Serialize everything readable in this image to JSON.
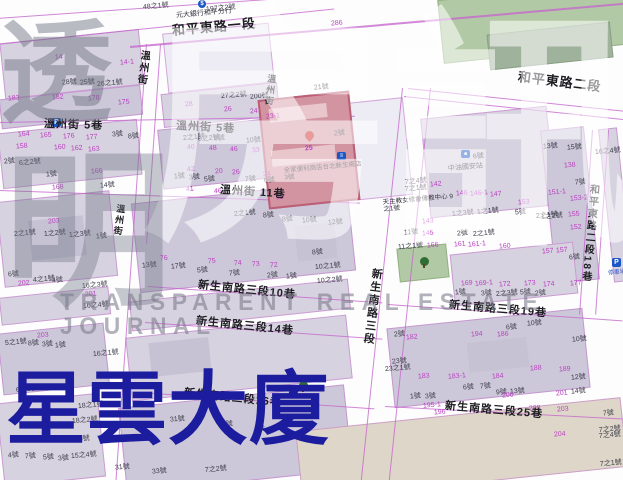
{
  "title": {
    "text": "星雲大廈",
    "color": "#1c1c9e"
  },
  "watermark": {
    "char_top": "透",
    "char_bottom": "明",
    "big_char_1": "房",
    "big_char_2": "訊",
    "banner": "TRANSPARENT REAL ESTATE JOURNAL"
  },
  "subject": {
    "store_label": "全家便利商店台北新生南店",
    "store_no": "3號",
    "marker_no": "25"
  },
  "pois": {
    "bank": {
      "label": "元大銀行和平分行",
      "icon": "$"
    },
    "gas": {
      "no": "6號",
      "label": "中油國安站"
    },
    "church": {
      "label": "天主教女修會傳教中心",
      "no": "9之1號"
    },
    "parking_left": {
      "icon": "P"
    },
    "parking_right": {
      "icon": "P",
      "label": "停車場"
    }
  },
  "streets": [
    [
      "和平東路一段",
      172,
      24,
      13,
      -5,
      0
    ],
    [
      "和平東路二段",
      518,
      70,
      13,
      7,
      0
    ],
    [
      "溫州街",
      139,
      50,
      10,
      7,
      1
    ],
    [
      "溫州街",
      267,
      74,
      9,
      7,
      1
    ],
    [
      "溫州街",
      116,
      204,
      9,
      7,
      1
    ],
    [
      "溫州街 5巷",
      44,
      119,
      11,
      2,
      0
    ],
    [
      "溫州街 5巷",
      176,
      121,
      11,
      3,
      0
    ],
    [
      "溫州街 11巷",
      220,
      185,
      11,
      4,
      0
    ],
    [
      "新生南路三段10巷",
      198,
      280,
      11,
      6,
      0
    ],
    [
      "新生南路三段14巷",
      196,
      316,
      11,
      6,
      0
    ],
    [
      "新生南路三段16巷",
      184,
      388,
      11,
      6,
      0
    ],
    [
      "新生南路三段19巷",
      449,
      300,
      11,
      5,
      0
    ],
    [
      "新生南路三段25巷",
      445,
      401,
      11,
      5,
      0
    ],
    [
      "新生南路三段",
      371,
      268,
      11,
      7,
      1
    ],
    [
      "和平東路二段18巷",
      588,
      184,
      10,
      5,
      1
    ]
  ],
  "lots": [
    [
      "48之1號",
      143,
      3,
      "k"
    ],
    [
      "197之2號",
      206,
      5,
      "k"
    ],
    [
      "286",
      331,
      20,
      "m"
    ],
    [
      "21號",
      314,
      84,
      "k"
    ],
    [
      "14",
      55,
      54,
      "m"
    ],
    [
      "14-1",
      120,
      59,
      "m"
    ],
    [
      "28號",
      62,
      79,
      "k"
    ],
    [
      "25號",
      80,
      79,
      "k"
    ],
    [
      "26之1號",
      97,
      80,
      "k"
    ],
    [
      "183",
      8,
      95,
      "m"
    ],
    [
      "182",
      52,
      94,
      "m"
    ],
    [
      "178",
      88,
      95,
      "m"
    ],
    [
      "175",
      118,
      99,
      "m"
    ],
    [
      "27之2號",
      221,
      92,
      "k"
    ],
    [
      "200號",
      250,
      93,
      "k"
    ],
    [
      "28",
      185,
      101,
      "m"
    ],
    [
      "26",
      224,
      106,
      "m"
    ],
    [
      "24",
      250,
      108,
      "m"
    ],
    [
      "23-1",
      266,
      113,
      "m"
    ],
    [
      "164",
      18,
      131,
      "m"
    ],
    [
      "165",
      40,
      132,
      "m"
    ],
    [
      "176",
      63,
      133,
      "m"
    ],
    [
      "177",
      86,
      134,
      "m"
    ],
    [
      "3號",
      112,
      131,
      "k"
    ],
    [
      "8號",
      128,
      133,
      "k"
    ],
    [
      "158",
      16,
      143,
      "m"
    ],
    [
      "160",
      54,
      144,
      "m"
    ],
    [
      "162",
      71,
      145,
      "m"
    ],
    [
      "163",
      88,
      146,
      "m"
    ],
    [
      "2號",
      4,
      158,
      "k"
    ],
    [
      "6之2號",
      19,
      159,
      "k"
    ],
    [
      "166",
      91,
      168,
      "m"
    ],
    [
      "1號",
      46,
      171,
      "k"
    ],
    [
      "168",
      52,
      184,
      "m"
    ],
    [
      "14號",
      100,
      182,
      "k"
    ],
    [
      "2之1號",
      183,
      134,
      "k"
    ],
    [
      "6之2號",
      198,
      135,
      "k"
    ],
    [
      "8號",
      214,
      135,
      "k"
    ],
    [
      "10號",
      246,
      137,
      "k"
    ],
    [
      "40",
      187,
      144,
      "m"
    ],
    [
      "48",
      209,
      145,
      "m"
    ],
    [
      "46",
      230,
      146,
      "m"
    ],
    [
      "33",
      252,
      147,
      "m"
    ],
    [
      "42",
      187,
      166,
      "m"
    ],
    [
      "20",
      215,
      168,
      "m"
    ],
    [
      "26",
      232,
      169,
      "m"
    ],
    [
      "24",
      263,
      171,
      "m"
    ],
    [
      "1號",
      174,
      173,
      "k"
    ],
    [
      "3號",
      189,
      174,
      "k"
    ],
    [
      "5號",
      204,
      176,
      "k"
    ],
    [
      "7號",
      245,
      176,
      "k"
    ],
    [
      "6號",
      264,
      177,
      "k"
    ],
    [
      "41",
      186,
      186,
      "m"
    ],
    [
      "46",
      214,
      188,
      "m"
    ],
    [
      "98",
      276,
      194,
      "m"
    ],
    [
      "2號",
      334,
      130,
      "k"
    ],
    [
      "2之1號",
      234,
      210,
      "k"
    ],
    [
      "8號",
      263,
      212,
      "k"
    ],
    [
      "8號",
      282,
      216,
      "k"
    ],
    [
      "10號",
      302,
      217,
      "k"
    ],
    [
      "12號",
      328,
      219,
      "k"
    ],
    [
      "203",
      48,
      218,
      "m"
    ],
    [
      "2之1號",
      14,
      230,
      "k"
    ],
    [
      "1之2號",
      44,
      230,
      "k"
    ],
    [
      "1之3號",
      69,
      231,
      "k"
    ],
    [
      "1號",
      96,
      233,
      "k"
    ],
    [
      "6號",
      8,
      271,
      "k"
    ],
    [
      "4之1號",
      33,
      276,
      "k"
    ],
    [
      "4號",
      52,
      277,
      "k"
    ],
    [
      "202",
      18,
      280,
      "m"
    ],
    [
      "16之3號",
      82,
      282,
      "k"
    ],
    [
      "201",
      85,
      291,
      "m"
    ],
    [
      "16之4號",
      83,
      302,
      "k"
    ],
    [
      "13號",
      142,
      262,
      "k"
    ],
    [
      "17號",
      171,
      263,
      "k"
    ],
    [
      "5號",
      197,
      267,
      "k"
    ],
    [
      "7號",
      229,
      270,
      "k"
    ],
    [
      "2號",
      267,
      272,
      "k"
    ],
    [
      "1號",
      286,
      273,
      "k"
    ],
    [
      "76",
      160,
      255,
      "m"
    ],
    [
      "75",
      208,
      258,
      "m"
    ],
    [
      "74",
      234,
      260,
      "m"
    ],
    [
      "73",
      252,
      261,
      "m"
    ],
    [
      "72",
      270,
      262,
      "m"
    ],
    [
      "203",
      37,
      332,
      "m"
    ],
    [
      "5之1號",
      5,
      339,
      "k"
    ],
    [
      "8號",
      28,
      340,
      "k"
    ],
    [
      "3號",
      42,
      341,
      "k"
    ],
    [
      "1號",
      55,
      342,
      "k"
    ],
    [
      "16之1號",
      93,
      350,
      "k"
    ],
    [
      "6之2號",
      16,
      386,
      "k"
    ],
    [
      "178",
      112,
      373,
      "m"
    ],
    [
      "18之1號",
      78,
      402,
      "k"
    ],
    [
      "18之2號",
      72,
      417,
      "k"
    ],
    [
      "2之3號",
      68,
      436,
      "k"
    ],
    [
      "15之4號",
      71,
      452,
      "k"
    ],
    [
      "4號",
      8,
      452,
      "k"
    ],
    [
      "7號",
      25,
      453,
      "k"
    ],
    [
      "5號",
      43,
      454,
      "k"
    ],
    [
      "3號",
      58,
      455,
      "k"
    ],
    [
      "31號",
      170,
      416,
      "k"
    ],
    [
      "6號",
      222,
      421,
      "k"
    ],
    [
      "4號",
      254,
      426,
      "k"
    ],
    [
      "31號",
      115,
      464,
      "k"
    ],
    [
      "33號",
      152,
      468,
      "k"
    ],
    [
      "7之2號",
      205,
      466,
      "k"
    ],
    [
      "7之4號",
      405,
      178,
      "k"
    ],
    [
      "7之1號",
      405,
      185,
      "k"
    ],
    [
      "142",
      430,
      181,
      "m"
    ],
    [
      "146",
      456,
      190,
      "m"
    ],
    [
      "146-1",
      470,
      190,
      "m"
    ],
    [
      "147",
      490,
      191,
      "m"
    ],
    [
      "153",
      518,
      199,
      "m"
    ],
    [
      "1之3號",
      452,
      210,
      "k"
    ],
    [
      "1之1號",
      477,
      208,
      "k"
    ],
    [
      "5號",
      515,
      209,
      "k"
    ],
    [
      "2之1號",
      536,
      212,
      "k"
    ],
    [
      "143",
      422,
      218,
      "m"
    ],
    [
      "11號",
      404,
      229,
      "k"
    ],
    [
      "145",
      422,
      230,
      "m"
    ],
    [
      "2號",
      457,
      230,
      "k"
    ],
    [
      "2之1號",
      473,
      230,
      "k"
    ],
    [
      "13號",
      543,
      143,
      "k"
    ],
    [
      "15號",
      567,
      144,
      "k"
    ],
    [
      "16之4號",
      595,
      148,
      "k"
    ],
    [
      "138",
      564,
      162,
      "m"
    ],
    [
      "7號",
      575,
      179,
      "k"
    ],
    [
      "151-1",
      548,
      189,
      "m"
    ],
    [
      "153-2",
      570,
      195,
      "m"
    ],
    [
      "155",
      568,
      211,
      "m"
    ],
    [
      "1之2號",
      541,
      213,
      "k"
    ],
    [
      "152",
      570,
      224,
      "m"
    ],
    [
      "157",
      556,
      247,
      "m"
    ],
    [
      "6號",
      569,
      254,
      "k"
    ],
    [
      "11之1號",
      398,
      243,
      "k"
    ],
    [
      "166",
      427,
      242,
      "m"
    ],
    [
      "161",
      454,
      241,
      "m"
    ],
    [
      "161-1",
      468,
      241,
      "m"
    ],
    [
      "160",
      499,
      243,
      "m"
    ],
    [
      "157",
      542,
      248,
      "m"
    ],
    [
      "8號",
      312,
      249,
      "k"
    ],
    [
      "10之1號",
      315,
      263,
      "k"
    ],
    [
      "10之2號",
      317,
      277,
      "k"
    ],
    [
      "169",
      461,
      280,
      "m"
    ],
    [
      "169-1",
      475,
      280,
      "m"
    ],
    [
      "172",
      499,
      281,
      "m"
    ],
    [
      "173",
      524,
      280,
      "m"
    ],
    [
      "174",
      543,
      281,
      "m"
    ],
    [
      "177",
      570,
      280,
      "m"
    ],
    [
      "1號",
      455,
      289,
      "k"
    ],
    [
      "3號",
      481,
      290,
      "k"
    ],
    [
      "2之3號",
      496,
      290,
      "k"
    ],
    [
      "5號",
      520,
      289,
      "k"
    ],
    [
      "2號",
      535,
      290,
      "k"
    ],
    [
      "10號",
      527,
      320,
      "k"
    ],
    [
      "6號",
      506,
      324,
      "k"
    ],
    [
      "10號",
      572,
      336,
      "k"
    ],
    [
      "12號",
      571,
      374,
      "k"
    ],
    [
      "14號",
      571,
      388,
      "k"
    ],
    [
      "2號",
      394,
      331,
      "k"
    ],
    [
      "182",
      406,
      334,
      "m"
    ],
    [
      "194",
      471,
      331,
      "m"
    ],
    [
      "186",
      497,
      331,
      "m"
    ],
    [
      "188",
      530,
      365,
      "m"
    ],
    [
      "189",
      559,
      366,
      "m"
    ],
    [
      "23號",
      392,
      358,
      "k"
    ],
    [
      "23之1號",
      385,
      365,
      "k"
    ],
    [
      "183",
      418,
      373,
      "m"
    ],
    [
      "183-1",
      448,
      373,
      "m"
    ],
    [
      "184",
      492,
      373,
      "m"
    ],
    [
      "6號",
      463,
      384,
      "k"
    ],
    [
      "7號",
      480,
      383,
      "k"
    ],
    [
      "9號",
      496,
      389,
      "k"
    ],
    [
      "13號",
      510,
      388,
      "k"
    ],
    [
      "200",
      502,
      392,
      "m"
    ],
    [
      "201",
      556,
      390,
      "m"
    ],
    [
      "1號",
      410,
      393,
      "k"
    ],
    [
      "3號",
      425,
      393,
      "k"
    ],
    [
      "195-1",
      423,
      402,
      "m"
    ],
    [
      "196",
      434,
      409,
      "m"
    ],
    [
      "208",
      529,
      405,
      "m"
    ],
    [
      "203",
      557,
      406,
      "m"
    ],
    [
      "204",
      554,
      431,
      "m"
    ],
    [
      "7號",
      603,
      410,
      "k"
    ],
    [
      "7之2號",
      599,
      426,
      "k"
    ],
    [
      "7之4號",
      599,
      432,
      "k"
    ],
    [
      "7之1號",
      600,
      460,
      "k"
    ]
  ]
}
